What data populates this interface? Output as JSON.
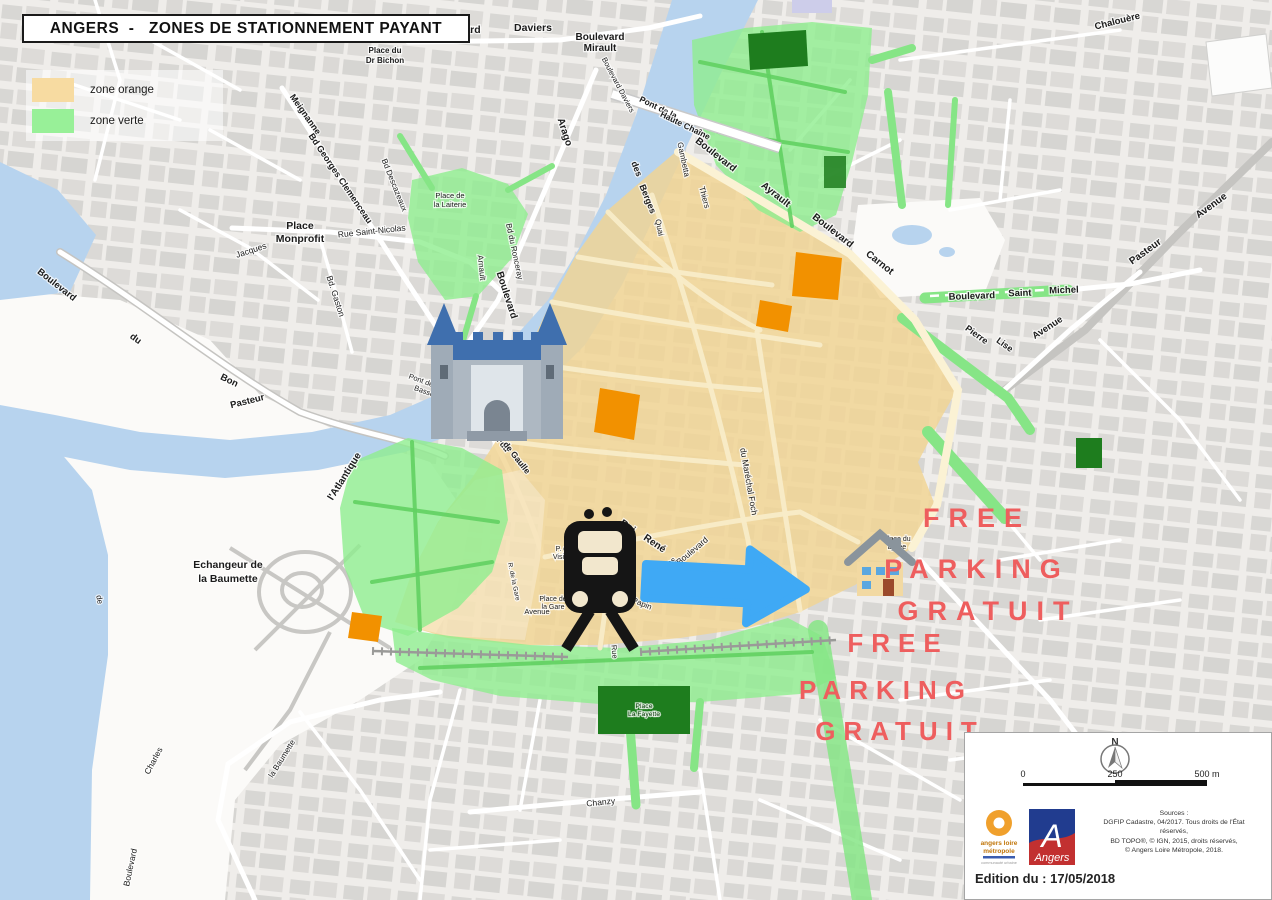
{
  "title": "ANGERS  -   ZONES DE STATIONNEMENT PAYANT",
  "legend": {
    "items": [
      {
        "label": "zone orange",
        "color": "#f7dba1"
      },
      {
        "label": "zone verte",
        "color": "#98f098"
      }
    ]
  },
  "colors": {
    "zone_orange": "#f2d493",
    "zone_verte": "#8fee8f",
    "river": "#b7d3ee",
    "landmark_orange": "#f29100",
    "dark_green": "#1e7d1e",
    "arrow_blue": "#3fa9f5",
    "free_parking_red": "#ee5e5e"
  },
  "annotations": {
    "color": "#ee5e5e",
    "free_parking": [
      {
        "t": "FREE",
        "x": 977,
        "y": 527,
        "s": 27,
        "ls": 9
      },
      {
        "t": "PARKING",
        "x": 977,
        "y": 578,
        "s": 27,
        "ls": 9
      },
      {
        "t": "GRATUIT",
        "x": 988,
        "y": 620,
        "s": 27,
        "ls": 9
      },
      {
        "t": "FREE",
        "x": 898,
        "y": 652,
        "s": 26,
        "ls": 8
      },
      {
        "t": "PARKING",
        "x": 886,
        "y": 699,
        "s": 26,
        "ls": 8
      },
      {
        "t": "GRATUIT",
        "x": 900,
        "y": 740,
        "s": 26,
        "ls": 8
      }
    ]
  },
  "map_labels": [
    {
      "t": "Boulevard",
      "x": 455,
      "y": 33,
      "r": 0,
      "s": 10.5,
      "b": 1
    },
    {
      "t": "Daviers",
      "x": 533,
      "y": 31,
      "r": 0,
      "s": 10.5,
      "b": 1
    },
    {
      "t": "Boulevard",
      "x": 600,
      "y": 40,
      "r": 0,
      "s": 10,
      "b": 1
    },
    {
      "t": "Mirault",
      "x": 600,
      "y": 51,
      "r": 0,
      "s": 10,
      "b": 1
    },
    {
      "t": "Place du",
      "x": 385,
      "y": 53,
      "r": 0,
      "s": 8,
      "b": 1
    },
    {
      "t": "Dr Bichon",
      "x": 385,
      "y": 63,
      "r": 0,
      "s": 8,
      "b": 1
    },
    {
      "t": "Chalouère",
      "x": 1118,
      "y": 24,
      "r": -14,
      "s": 9.5,
      "b": 1
    },
    {
      "t": "Meignanne",
      "x": 303,
      "y": 116,
      "r": 55,
      "s": 9,
      "b": 1
    },
    {
      "t": "Bd Georges Clemenceau",
      "x": 338,
      "y": 180,
      "r": 56,
      "s": 9,
      "b": 1
    },
    {
      "t": "Bd Descazeaux",
      "x": 392,
      "y": 186,
      "r": 68,
      "s": 8,
      "b": 0
    },
    {
      "t": "Place",
      "x": 300,
      "y": 229,
      "r": 0,
      "s": 10.5,
      "b": 1
    },
    {
      "t": "Monprofit",
      "x": 300,
      "y": 242,
      "r": 0,
      "s": 10.5,
      "b": 1
    },
    {
      "t": "Rue Saint-Nicolas",
      "x": 372,
      "y": 234,
      "r": -6,
      "s": 8.5,
      "b": 0
    },
    {
      "t": "Jacques",
      "x": 252,
      "y": 253,
      "r": -18,
      "s": 8.5,
      "b": 0
    },
    {
      "t": "Bd. Gaston",
      "x": 333,
      "y": 297,
      "r": 72,
      "s": 8.5,
      "b": 0
    },
    {
      "t": "Place de",
      "x": 450,
      "y": 198,
      "r": 0,
      "s": 7.5,
      "b": 0
    },
    {
      "t": "la Laiterie",
      "x": 450,
      "y": 207,
      "r": 0,
      "s": 7.5,
      "b": 0
    },
    {
      "t": "Bd du Ronceray",
      "x": 512,
      "y": 252,
      "r": 78,
      "s": 8,
      "b": 0
    },
    {
      "t": "Arnault",
      "x": 479,
      "y": 268,
      "r": 84,
      "s": 8,
      "b": 0
    },
    {
      "t": "Arago",
      "x": 562,
      "y": 133,
      "r": 72,
      "s": 10,
      "b": 1
    },
    {
      "t": "Boulevard",
      "x": 504,
      "y": 296,
      "r": 72,
      "s": 10,
      "b": 1
    },
    {
      "t": "Boulevard Daviers",
      "x": 616,
      "y": 86,
      "r": 62,
      "s": 7.5,
      "b": 0
    },
    {
      "t": "Pont de la",
      "x": 657,
      "y": 110,
      "r": 26,
      "s": 8.5,
      "b": 1
    },
    {
      "t": "Haute Chaîne",
      "x": 684,
      "y": 128,
      "r": 26,
      "s": 8.5,
      "b": 1
    },
    {
      "t": "des",
      "x": 634,
      "y": 170,
      "r": 68,
      "s": 9,
      "b": 1
    },
    {
      "t": "Berges",
      "x": 645,
      "y": 200,
      "r": 68,
      "s": 9,
      "b": 1
    },
    {
      "t": "Quai",
      "x": 657,
      "y": 228,
      "r": 78,
      "s": 8,
      "b": 0
    },
    {
      "t": "Gambetta",
      "x": 681,
      "y": 160,
      "r": 78,
      "s": 8,
      "b": 0
    },
    {
      "t": "Thiers",
      "x": 702,
      "y": 198,
      "r": 75,
      "s": 8,
      "b": 0
    },
    {
      "t": "Boulevard",
      "x": 714,
      "y": 157,
      "r": 38,
      "s": 10,
      "b": 1
    },
    {
      "t": "Ayrault",
      "x": 774,
      "y": 197,
      "r": 38,
      "s": 10,
      "b": 1
    },
    {
      "t": "Boulevard",
      "x": 831,
      "y": 233,
      "r": 38,
      "s": 10,
      "b": 1
    },
    {
      "t": "Carnot",
      "x": 878,
      "y": 265,
      "r": 38,
      "s": 10,
      "b": 1
    },
    {
      "t": "Boulevard",
      "x": 972,
      "y": 299,
      "r": -2,
      "s": 9.5,
      "b": 1
    },
    {
      "t": "Saint",
      "x": 1020,
      "y": 296,
      "r": -2,
      "s": 9.5,
      "b": 1
    },
    {
      "t": "Michel",
      "x": 1064,
      "y": 293,
      "r": -2,
      "s": 9.5,
      "b": 1
    },
    {
      "t": "Pierre",
      "x": 975,
      "y": 337,
      "r": 36,
      "s": 9,
      "b": 1
    },
    {
      "t": "Lise",
      "x": 1003,
      "y": 347,
      "r": 36,
      "s": 9,
      "b": 1
    },
    {
      "t": "Avenue",
      "x": 1049,
      "y": 330,
      "r": -33,
      "s": 9.5,
      "b": 1
    },
    {
      "t": "Avenue",
      "x": 1213,
      "y": 208,
      "r": -36,
      "s": 10,
      "b": 1
    },
    {
      "t": "Pasteur",
      "x": 1147,
      "y": 254,
      "r": -36,
      "s": 10,
      "b": 1
    },
    {
      "t": "Boulevard du",
      "x": 489,
      "y": 431,
      "r": 52,
      "s": 8.5,
      "b": 1
    },
    {
      "t": "Général de Gaulle",
      "x": 504,
      "y": 446,
      "r": 52,
      "s": 8.5,
      "b": 1
    },
    {
      "t": "l'Atlantique",
      "x": 347,
      "y": 478,
      "r": -58,
      "s": 10,
      "b": 1
    },
    {
      "t": "Pasteur",
      "x": 248,
      "y": 404,
      "r": -14,
      "s": 9.5,
      "b": 1
    },
    {
      "t": "Boulevard",
      "x": 55,
      "y": 287,
      "r": 38,
      "s": 9.5,
      "b": 1
    },
    {
      "t": "du",
      "x": 134,
      "y": 341,
      "r": 36,
      "s": 9.5,
      "b": 1
    },
    {
      "t": "Bon",
      "x": 228,
      "y": 383,
      "r": 26,
      "s": 9.5,
      "b": 1
    },
    {
      "t": "Pont de la",
      "x": 424,
      "y": 384,
      "r": 20,
      "s": 7.5,
      "b": 0
    },
    {
      "t": "Basse-Chaîne",
      "x": 436,
      "y": 398,
      "r": 20,
      "s": 7.5,
      "b": 0
    },
    {
      "t": "Echangeur de",
      "x": 228,
      "y": 568,
      "r": 0,
      "s": 10.5,
      "b": 1
    },
    {
      "t": "la Baumette",
      "x": 228,
      "y": 582,
      "r": 0,
      "s": 10.5,
      "b": 1
    },
    {
      "t": "Place de",
      "x": 553,
      "y": 601,
      "r": 0,
      "s": 7,
      "b": 0
    },
    {
      "t": "la Gare",
      "x": 553,
      "y": 609,
      "r": 0,
      "s": 7,
      "b": 0
    },
    {
      "t": "P. de la",
      "x": 567,
      "y": 551,
      "r": 0,
      "s": 7,
      "b": 0
    },
    {
      "t": "Visitation",
      "x": 567,
      "y": 559,
      "r": 0,
      "s": 7,
      "b": 0
    },
    {
      "t": "R. de la Gare",
      "x": 512,
      "y": 582,
      "r": 78,
      "s": 6.5,
      "b": 0
    },
    {
      "t": "Avenue",
      "x": 537,
      "y": 614,
      "r": 0,
      "s": 7.5,
      "b": 0
    },
    {
      "t": "Papin",
      "x": 641,
      "y": 606,
      "r": 22,
      "s": 8,
      "b": 0
    },
    {
      "t": "Roi",
      "x": 626,
      "y": 529,
      "r": 34,
      "s": 10,
      "b": 1
    },
    {
      "t": "René",
      "x": 653,
      "y": 546,
      "r": 34,
      "s": 10,
      "b": 1
    },
    {
      "t": "Haras",
      "x": 668,
      "y": 568,
      "r": -40,
      "s": 8.5,
      "b": 0
    },
    {
      "t": "Boulevard",
      "x": 694,
      "y": 553,
      "r": -40,
      "s": 8.5,
      "b": 0
    },
    {
      "t": "du Maréchal Foch",
      "x": 746,
      "y": 482,
      "r": 80,
      "s": 8.5,
      "b": 0
    },
    {
      "t": "Paul",
      "x": 737,
      "y": 598,
      "r": 30,
      "s": 8.5,
      "b": 0
    },
    {
      "t": "Place du",
      "x": 897,
      "y": 541,
      "r": 0,
      "s": 7,
      "b": 0
    },
    {
      "t": "Lycée",
      "x": 897,
      "y": 549,
      "r": 0,
      "s": 7,
      "b": 0
    },
    {
      "t": "Rue",
      "x": 612,
      "y": 652,
      "r": 85,
      "s": 7.5,
      "b": 0
    },
    {
      "t": "Place",
      "x": 644,
      "y": 708,
      "r": 0,
      "s": 6.8,
      "b": 0,
      "c": "#0b3b0b"
    },
    {
      "t": "La Fayette",
      "x": 644,
      "y": 716,
      "r": 0,
      "s": 6.8,
      "b": 0,
      "c": "#0b3b0b"
    },
    {
      "t": "Chanzy",
      "x": 601,
      "y": 805,
      "r": -6,
      "s": 8.5,
      "b": 0
    },
    {
      "t": "Boulevard",
      "x": 133,
      "y": 868,
      "r": -78,
      "s": 8.5,
      "b": 0
    },
    {
      "t": "Charles",
      "x": 156,
      "y": 762,
      "r": -62,
      "s": 8.5,
      "b": 0
    },
    {
      "t": "la Baumette",
      "x": 284,
      "y": 760,
      "r": -58,
      "s": 8,
      "b": 0
    },
    {
      "t": "de",
      "x": 97,
      "y": 600,
      "r": 80,
      "s": 8,
      "b": 0
    }
  ],
  "info": {
    "north": "N",
    "scale": {
      "start": "0",
      "mid": "250",
      "end": "500 m"
    },
    "logos": {
      "alm_line1": "angers loire",
      "alm_line2": "métropole",
      "alm_line3": "communauté urbaine",
      "angers_initial": "A",
      "angers_name": "Angers"
    },
    "sources": [
      "Sources :",
      "DGFIP Cadastre, 04/2017. Tous droits de l'État",
      "réservés,",
      "BD TOPO®, © IGN, 2015, droits réservés,",
      "© Angers Loire Métropole, 2018."
    ],
    "edition": "Edition du : 17/05/2018"
  }
}
